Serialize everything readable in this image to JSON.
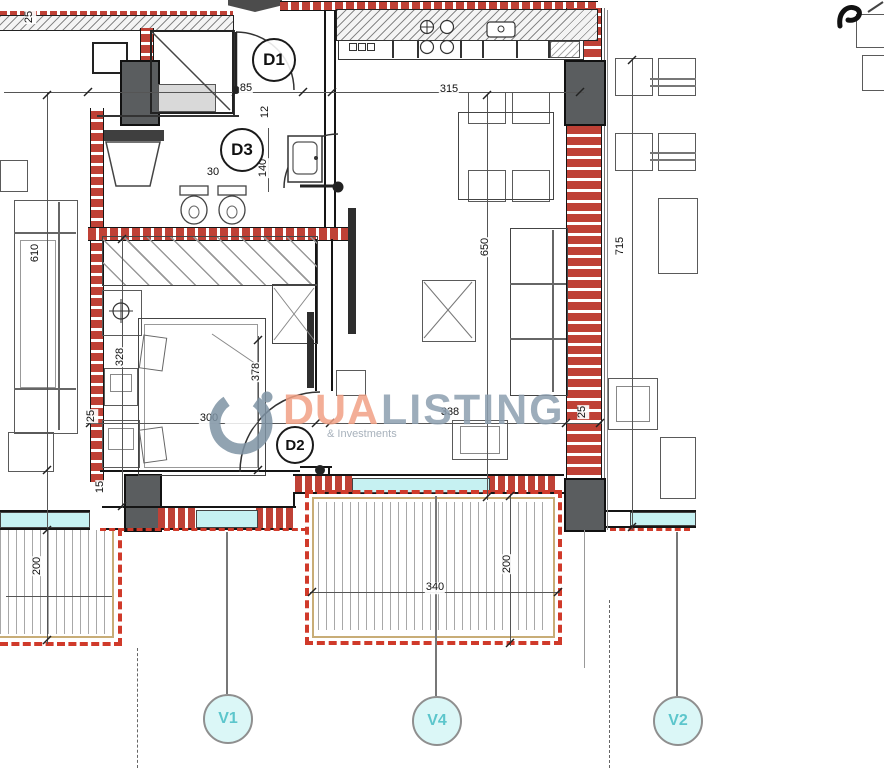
{
  "meta": {
    "drawing_type": "apartment floor plan"
  },
  "watermark": {
    "brand": "DUA",
    "brand2": "LISTING",
    "tagline": "& Investments"
  },
  "labels": {
    "d1": "D1",
    "d2": "D2",
    "d3": "D3",
    "v1": "V1",
    "v4": "V4",
    "v2": "V2"
  },
  "dims": {
    "wall_top": "25",
    "entry": "85",
    "hall": "12",
    "wc": "30",
    "bath": "140",
    "kitchen": "315",
    "living_len": "650",
    "right_len": "715",
    "left_len": "610",
    "bed_inner": "328",
    "bed_wall": "25",
    "bed_w": "300",
    "bed_len": "378",
    "living_w": "338",
    "living_wall": "25",
    "terrace_w": "340",
    "terrace_d": "200",
    "terrace_left_d": "200",
    "sill": "15"
  },
  "colors": {
    "wall_red": "#bf4136",
    "pillar": "#5a5d5f",
    "window_cyan": "#c6f1f2",
    "terrace_dash": "#d03a2a",
    "terrace_tan": "#c8ad77",
    "mark_fill": "#dbf7f7",
    "mark_text": "#5cc6cc",
    "brand_orange": "#f2a185",
    "brand_gray": "#8d9fb0"
  }
}
